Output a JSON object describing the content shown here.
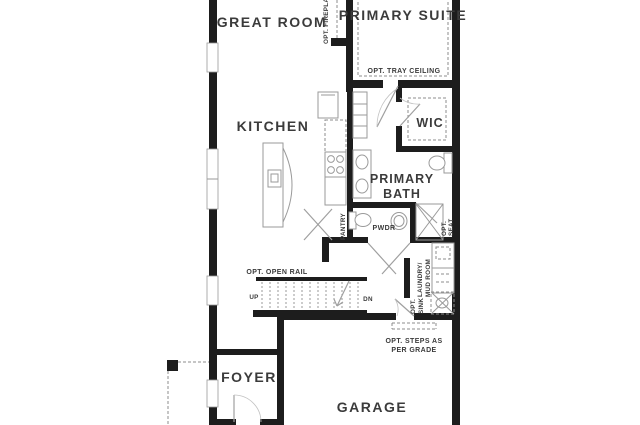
{
  "labels": {
    "great_room": "GREAT ROOM",
    "primary_suite": "PRIMARY SUITE",
    "kitchen": "KITCHEN",
    "wic": "WIC",
    "primary_bath_1": "PRIMARY",
    "primary_bath_2": "BATH",
    "pwdr": "PWDR",
    "pantry": "PANTRY",
    "foyer": "FOYER",
    "garage": "GARAGE",
    "laundry_1": "LAUNDRY/",
    "laundry_2": "MUD ROOM"
  },
  "annotations": {
    "opt_fireplace": "OPT. FIREPLACE",
    "opt_tray_ceiling": "OPT. TRAY CEILING",
    "opt_open_rail": "OPT. OPEN RAIL",
    "up": "UP",
    "dn": "DN",
    "opt_seat_1": "OPT.",
    "opt_seat_2": "SEAT",
    "opt_sink_1": "OPT.",
    "opt_sink_2": "SINK",
    "opt_steps_1": "OPT. STEPS AS",
    "opt_steps_2": "PER GRADE"
  },
  "colors": {
    "wall": "#1d1d1d",
    "line": "#9a9a9a",
    "dash": "#8c8c8c",
    "text": "#3b3b3b",
    "background": "#ffffff"
  }
}
